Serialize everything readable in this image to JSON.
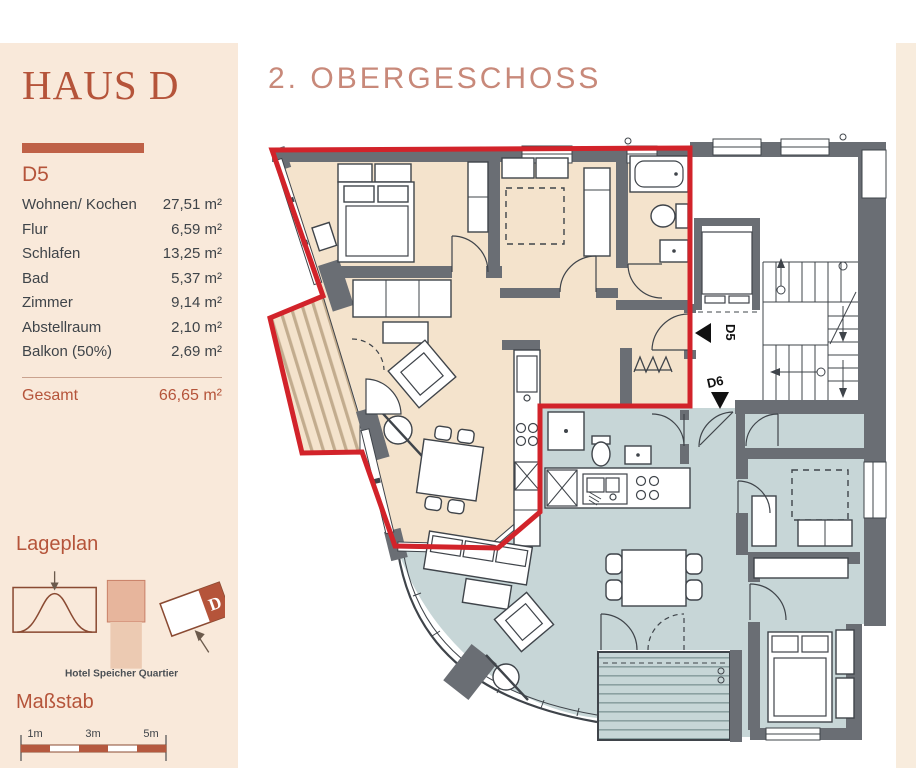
{
  "sidebar": {
    "title": "HAUS D",
    "unit_label": "D5",
    "rooms": [
      {
        "label": "Wohnen/ Kochen",
        "area": "27,51 m²"
      },
      {
        "label": "Flur",
        "area": "6,59 m²"
      },
      {
        "label": "Schlafen",
        "area": "13,25 m²"
      },
      {
        "label": "Bad",
        "area": "5,37 m²"
      },
      {
        "label": "Zimmer",
        "area": "9,14 m²"
      },
      {
        "label": "Abstellraum",
        "area": "2,10 m²"
      },
      {
        "label": "Balkon (50%)",
        "area": "2,69 m²"
      }
    ],
    "total": {
      "label": "Gesamt",
      "area": "66,65 m²"
    },
    "lageplan": {
      "heading": "Lageplan",
      "caption": "Hotel Speicher Quartier",
      "building_label": "D"
    },
    "massstab": {
      "heading": "Maßstab",
      "labels": [
        "1m",
        "3m",
        "5m"
      ]
    }
  },
  "plan": {
    "title": "2. OBERGESCHOSS",
    "d5_label": "D5",
    "d6_label": "D6"
  },
  "colors": {
    "sidebar_bg": "#f9e9da",
    "terracotta": "#b5543a",
    "divider_bar": "#bf6147",
    "plan_title": "#c8897a",
    "boundary_red": "#d2232a",
    "apartment_d5_floor": "#f4e3cc",
    "apartment_d6_floor": "#c7d6d7",
    "wall_gray": "#6a6e74",
    "text_dark": "#3f4449"
  }
}
